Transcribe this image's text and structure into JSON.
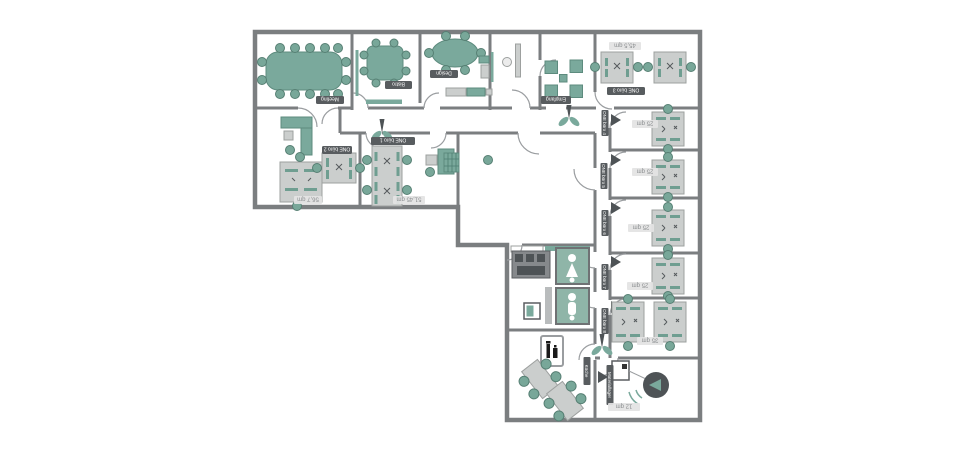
{
  "plan": {
    "rooms": {
      "meeting": {
        "name": "Meeting"
      },
      "bistro": {
        "name": "Bistro"
      },
      "design": {
        "name": "Design"
      },
      "empfang": {
        "name": "Empfang"
      },
      "buero3": {
        "name": "ONE büro 3",
        "area": "45,5 qm"
      },
      "buero2": {
        "name": "ONE büro 2",
        "area": "56,7 qm"
      },
      "buero1": {
        "name": "ONE büro 1",
        "area": "51,45 qm"
      },
      "buero4": {
        "name": "ONE büro 4",
        "area": "25 qm"
      },
      "buero5": {
        "name": "ONE büro 5",
        "area": "25 qm"
      },
      "buero6": {
        "name": "ONE büro 6",
        "area": "25 qm"
      },
      "buero7": {
        "name": "ONE büro 7",
        "area": "25 qm"
      },
      "buero8": {
        "name": "ONE büro 8",
        "area": "35 qm"
      },
      "kueche": {
        "name": "Küche"
      },
      "lager": {
        "name": "Materiallager",
        "area": "12 qm"
      }
    },
    "colors": {
      "wall": "#7b7e80",
      "furniture_teal": "#7aa99c",
      "desk_gray": "#cbcecd",
      "label_chip_dark": "#585c5f",
      "label_chip_light": "#e3e3e3",
      "wc_fill": "#8fb5a8",
      "dark_object": "#4e5356",
      "background": "#ffffff"
    },
    "icons": [
      "plant-icon",
      "wc-woman-icon",
      "wc-man-icon",
      "elevator-icon",
      "speaker-icon",
      "extinguisher-sign-icon",
      "door-arc",
      "washer-icon"
    ]
  }
}
